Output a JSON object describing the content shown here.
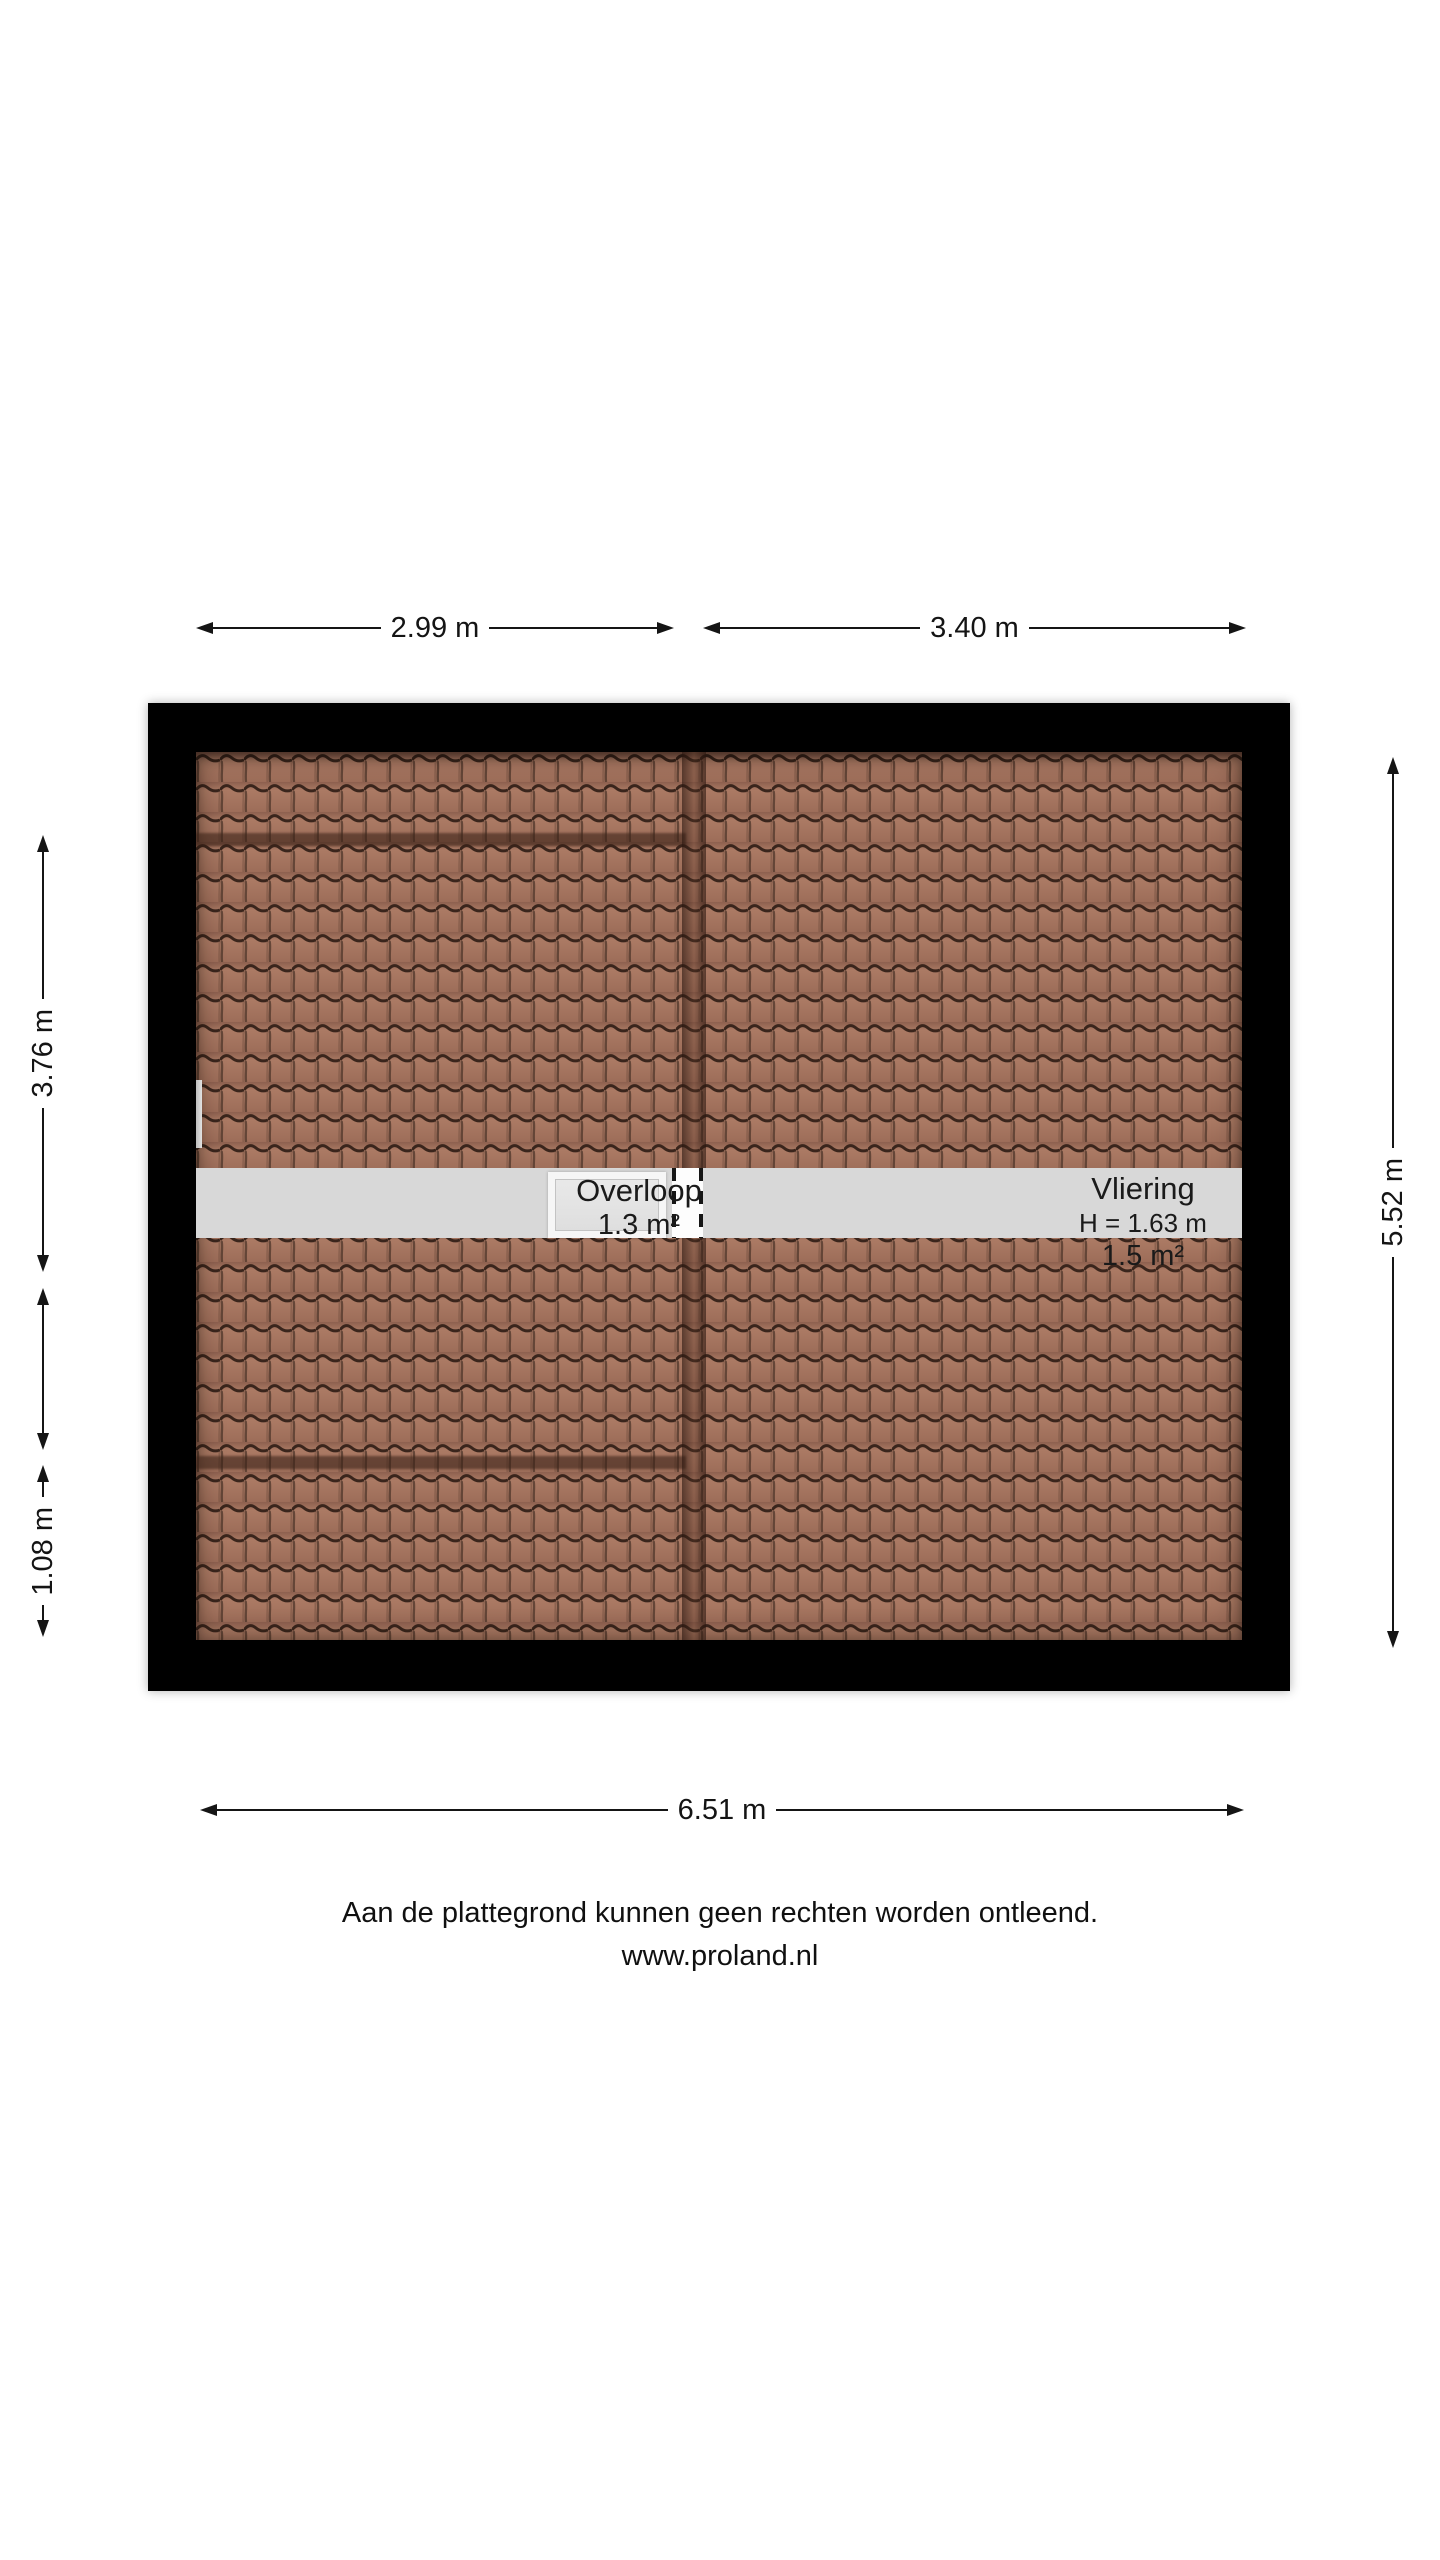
{
  "plan": {
    "type": "floor-plan",
    "rooms": [
      {
        "name": "Overloop",
        "area": "1.3 m²"
      },
      {
        "name": "Vliering",
        "height_label": "H = 1.63 m",
        "area": "1.5 m²"
      }
    ],
    "colors": {
      "wall": "#000000",
      "tile": "#a1705c",
      "tile_line": "#3a251c",
      "corridor_band": "#d8d8d8"
    }
  },
  "dimensions": {
    "top_left": "2.99 m",
    "top_right": "3.40 m",
    "left_upper": "3.76 m",
    "left_lower": "1.08 m",
    "right": "5.52 m",
    "bottom": "6.51 m"
  },
  "footer": {
    "line1": "Aan de plattegrond kunnen geen rechten worden ontleend.",
    "line2": "www.proland.nl"
  }
}
